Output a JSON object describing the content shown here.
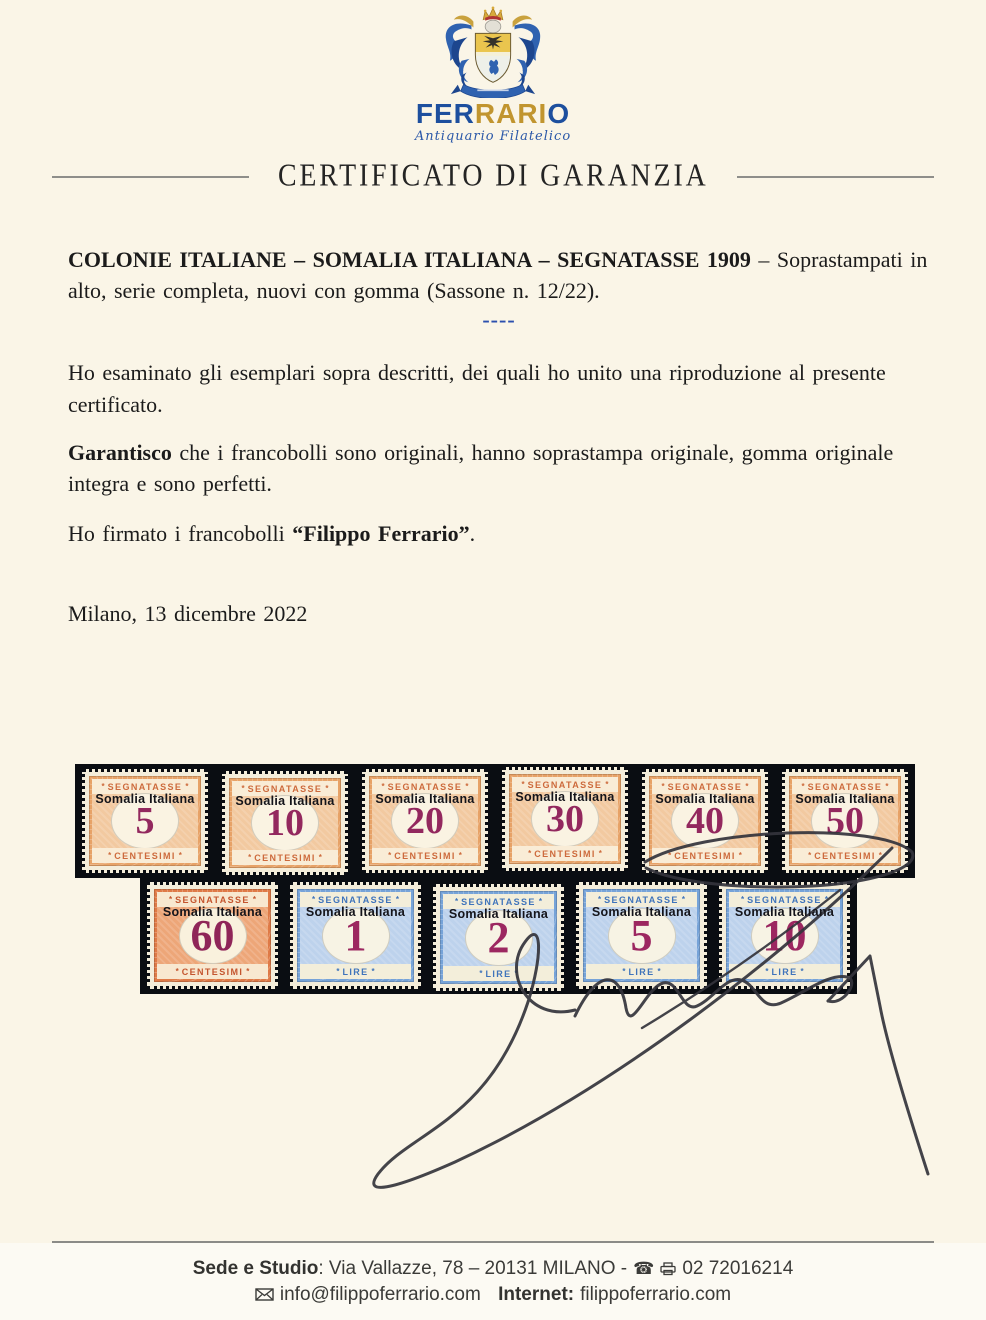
{
  "logo": {
    "part1": "FER",
    "part2": "RARI",
    "part3": "O",
    "subtitle": "Antiquario Filatelico",
    "colors": {
      "blue": "#1d4f9e",
      "gold": "#c1952f"
    }
  },
  "title": {
    "text": "CERTIFICATO DI GARANZIA"
  },
  "intro": {
    "bold": "COLONIE ITALIANE – SOMALIA ITALIANA – SEGNATASSE 1909",
    "rest": " – Soprastampati in alto, serie completa, nuovi con gomma (Sassone n. 12/22)."
  },
  "divider": {
    "dashes": "----",
    "color": "#2b4fae"
  },
  "body": {
    "examined": "Ho esaminato gli esemplari sopra descritti, dei quali ho unito una riproduzione al presente certificato.",
    "guarantee_bold": "Garantisco",
    "guarantee_rest": " che i francobolli sono originali, hanno soprastampa originale, gomma originale integra e sono perfetti.",
    "signed_prefix": "Ho firmato i francobolli ",
    "signed_bold": "“Filippo Ferrario”",
    "signed_suffix": ".",
    "dateline": "Milano, 13 dicembre 2022"
  },
  "stamps": {
    "strip_background": "#0a0d12",
    "top_label": "SEGNATASSE",
    "overprint": "Somalia Italiana",
    "ornament": "*",
    "row1": [
      {
        "value": "5",
        "bottom": "CENTESIMI",
        "palette": "orange"
      },
      {
        "value": "10",
        "bottom": "CENTESIMI",
        "palette": "orange"
      },
      {
        "value": "20",
        "bottom": "CENTESIMI",
        "palette": "orange"
      },
      {
        "value": "30",
        "bottom": "CENTESIMI",
        "palette": "orange"
      },
      {
        "value": "40",
        "bottom": "CENTESIMI",
        "palette": "orange"
      },
      {
        "value": "50",
        "bottom": "CENTESIMI",
        "palette": "orange"
      }
    ],
    "row2": [
      {
        "value": "60",
        "bottom": "CENTESIMI",
        "palette": "deep_orange"
      },
      {
        "value": "1",
        "bottom": "LIRE",
        "palette": "blue"
      },
      {
        "value": "2",
        "bottom": "LIRE",
        "palette": "blue"
      },
      {
        "value": "5",
        "bottom": "LIRE",
        "palette": "blue"
      },
      {
        "value": "10",
        "bottom": "LIRE",
        "palette": "blue"
      }
    ],
    "palettes": {
      "orange": {
        "frame": "#e7a267",
        "center": "#f2c9a0",
        "band": "#f9ecd6",
        "ink": "#cd6a3c",
        "numeral": "#93285e",
        "oval": "#faf3e2"
      },
      "deep_orange": {
        "frame": "#df7a47",
        "center": "#eda678",
        "band": "#f8e8d0",
        "ink": "#c4552e",
        "numeral": "#8f2558",
        "oval": "#f9f1dd"
      },
      "blue": {
        "frame": "#76a3d8",
        "center": "#bdd2ec",
        "band": "#f3eeda",
        "ink": "#3f74bb",
        "numeral": "#9c2760",
        "oval": "#f7f3e4"
      }
    }
  },
  "signature": {
    "ink": "#34343c"
  },
  "footer": {
    "line1_bold": "Sede e Studio",
    "line1_rest": ": Via Vallazze, 78 – 20131 MILANO -",
    "phone_glyph": "☎",
    "phone_number": "02 72016214",
    "email": "info@filippoferrario.com",
    "internet_label": "Internet:",
    "website": "filippoferrario.com"
  }
}
